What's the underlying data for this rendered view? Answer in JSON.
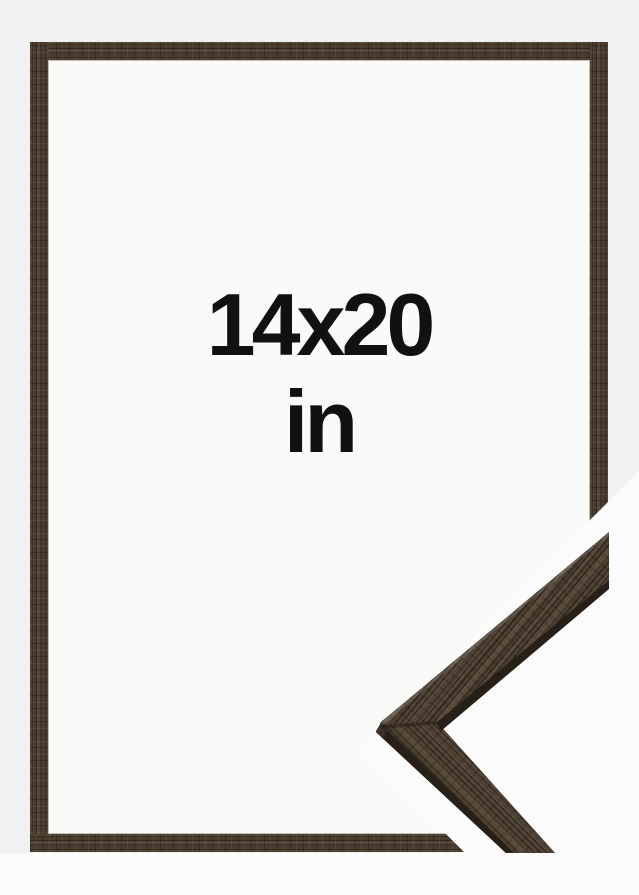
{
  "size_label": {
    "line1": "14x20",
    "line2": "in"
  },
  "frame": {
    "style": "thin dark brown wood frame",
    "interior": "empty white"
  },
  "corner_detail": {
    "description": "enlarged moulding corner sample, bottom right"
  },
  "colors": {
    "page_bg": "#eff1f2",
    "detail_bg": "#fafbfa",
    "frame_interior": "#fafaf8",
    "wood_base": "#4a3d30",
    "wood_dark": "#33291f",
    "wood_light": "#5f5040",
    "side_face": "#262019",
    "text": "#111111"
  }
}
